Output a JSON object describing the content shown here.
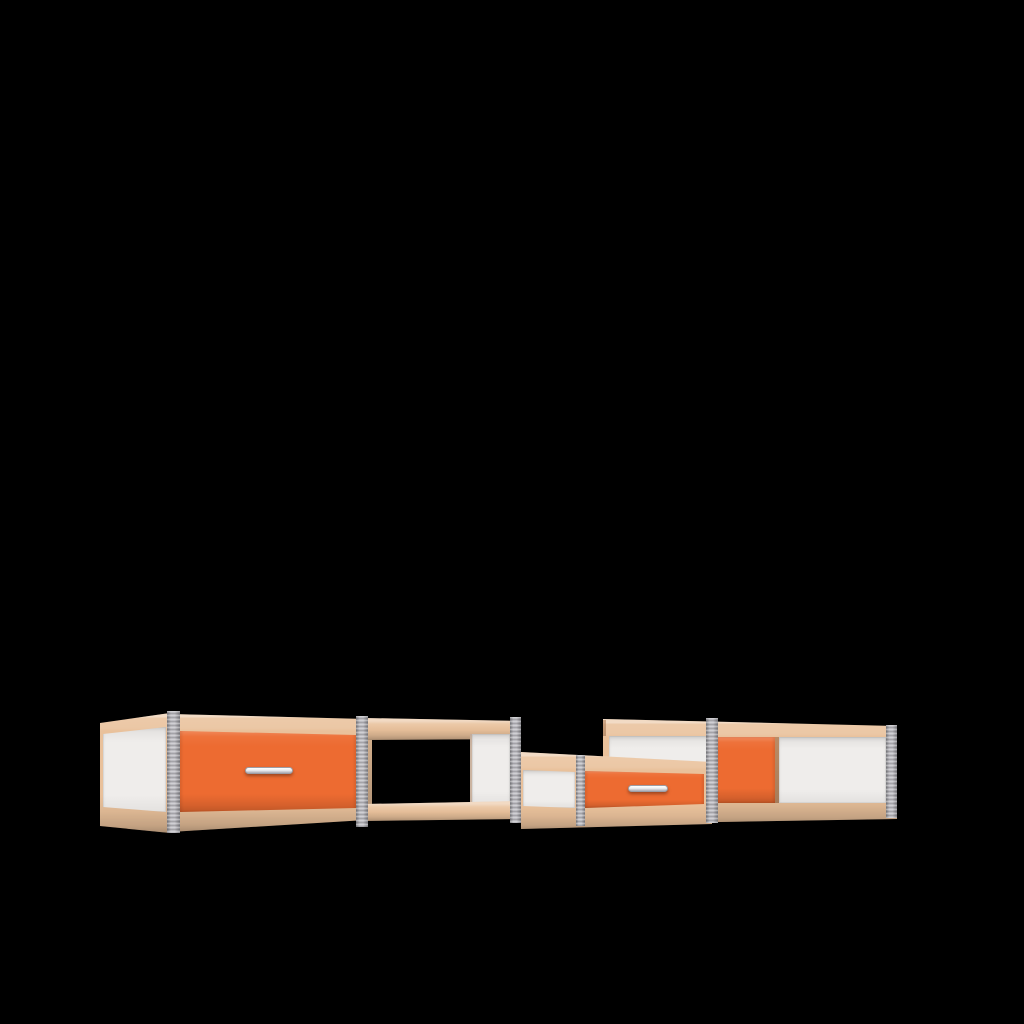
{
  "scene": {
    "title": "3D render of a modular low sideboard on a black background",
    "background": "#000000"
  },
  "colors": {
    "background": "#000000",
    "wood": "#e9c19b",
    "wood_dark": "#c89166",
    "panel_white": "#efedeb",
    "drawer_orange": "#ed6b31",
    "post_gray": "#b4b3b9",
    "handle_silver": "#e9eaec"
  },
  "modules": [
    {
      "id": "left-drawer-module",
      "description": "Tall box with full-width orange drawer front, silver bar handle, white left side panel, beech rails, gray corner posts"
    },
    {
      "id": "open-shelf-module",
      "description": "Open see-through compartment with beech top and bottom rails and white partition panel at its right end"
    },
    {
      "id": "low-drawer-module",
      "description": "Lower box with narrow white front section and orange drawer front with silver bar handle between gray posts"
    },
    {
      "id": "right-cabinet-module",
      "description": "Tall box behind the low module with orange and white sliding door panels, beech rails and gray end post"
    }
  ]
}
